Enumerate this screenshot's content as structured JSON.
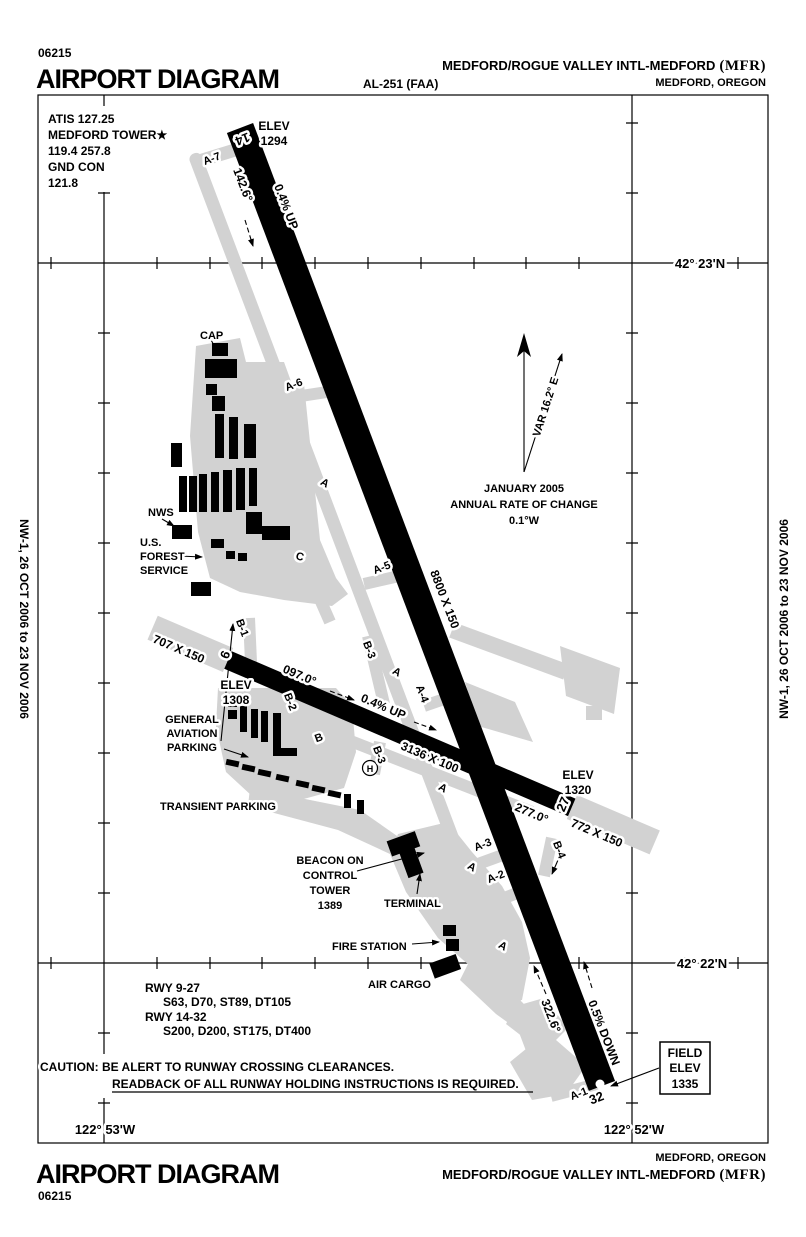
{
  "colors": {
    "pavement": "#000000",
    "apron": "#d2d2d2",
    "background": "#ffffff"
  },
  "header": {
    "chart_id": "06215",
    "title": "AIRPORT DIAGRAM",
    "al_number": "AL-251 (FAA)",
    "airport_name": "MEDFORD/ROGUE VALLEY INTL-MEDFORD",
    "airport_code": "(MFR)",
    "city_state": "MEDFORD, OREGON"
  },
  "footer": {
    "chart_id": "06215",
    "title": "AIRPORT DIAGRAM",
    "airport_name": "MEDFORD/ROGUE VALLEY INTL-MEDFORD",
    "airport_code": "(MFR)",
    "city_state": "MEDFORD, OREGON"
  },
  "comms": {
    "atis": "ATIS 127.25",
    "tower_name": "MEDFORD TOWER★",
    "tower_freqs": "119.4  257.8",
    "ground_name": "GND CON",
    "ground_freq": "121.8"
  },
  "margin_note": {
    "left": "NW-1, 26 OCT 2006 to 23 NOV 2006",
    "right": "NW-1, 26 OCT 2006 to 23 NOV 2006"
  },
  "coordinates": {
    "lat_top": "42° 23'N",
    "lat_bottom": "42° 22'N",
    "lon_left": "122° 53'W",
    "lon_right": "122° 52'W"
  },
  "compass": {
    "variation": "VAR 16.2° E",
    "date": "JANUARY 2005",
    "rate_line1": "ANNUAL RATE OF CHANGE",
    "rate_line2": "0.1°W"
  },
  "runways": {
    "rwy_14_32": {
      "num_14": "14",
      "num_32": "32",
      "dimensions": "8800 X 150",
      "heading_14": "142.6°",
      "heading_32": "322.6°",
      "slope_north": "0.4% UP",
      "slope_south": "0.5% DOWN",
      "elev_14_label": "ELEV",
      "elev_14_value": "1294"
    },
    "rwy_9_27": {
      "num_9": "9",
      "num_27": "27",
      "dimensions": "3136 X 100",
      "heading_9": "097.0°",
      "heading_27": "277.0°",
      "slope": "0.4% UP",
      "overrun_9": "707 X 150",
      "overrun_27": "772 X 150",
      "elev_9_label": "ELEV",
      "elev_9_value": "1308",
      "elev_27_label": "ELEV",
      "elev_27_value": "1320"
    }
  },
  "field_elevation": {
    "line1": "FIELD",
    "line2": "ELEV",
    "line3": "1335"
  },
  "taxiways": {
    "a7": "A-7",
    "a6": "A-6",
    "a_upper": "A",
    "a5": "A-5",
    "c": "C",
    "b1": "B-1",
    "b2": "B-2",
    "b": "B",
    "b3_upper": "B-3",
    "b3_lower": "B-3",
    "a4": "A-4",
    "a_mid": "A",
    "a_low": "A",
    "a3": "A-3",
    "a_terminal": "A",
    "a2": "A-2",
    "a_cargo": "A",
    "b4": "B-4",
    "a1": "A-1"
  },
  "facilities": {
    "cap": "CAP",
    "nws": "NWS",
    "usfs_line1": "U.S.",
    "usfs_line2": "FOREST",
    "usfs_line3": "SERVICE",
    "ga_line1": "GENERAL",
    "ga_line2": "AVIATION",
    "ga_line3": "PARKING",
    "transient": "TRANSIENT PARKING",
    "beacon_line1": "BEACON ON",
    "beacon_line2": "CONTROL",
    "beacon_line3": "TOWER",
    "beacon_line4": "1389",
    "terminal": "TERMINAL",
    "fire_station": "FIRE STATION",
    "air_cargo": "AIR CARGO",
    "helipad": "H"
  },
  "runway_data": {
    "line1": "RWY 9-27",
    "line2": "S63, D70, ST89, DT105",
    "line3": "RWY 14-32",
    "line4": "S200, D200, ST175, DT400"
  },
  "caution": {
    "line1": "CAUTION: BE ALERT TO RUNWAY CROSSING CLEARANCES.",
    "line2": "READBACK OF ALL RUNWAY HOLDING INSTRUCTIONS IS REQUIRED."
  }
}
